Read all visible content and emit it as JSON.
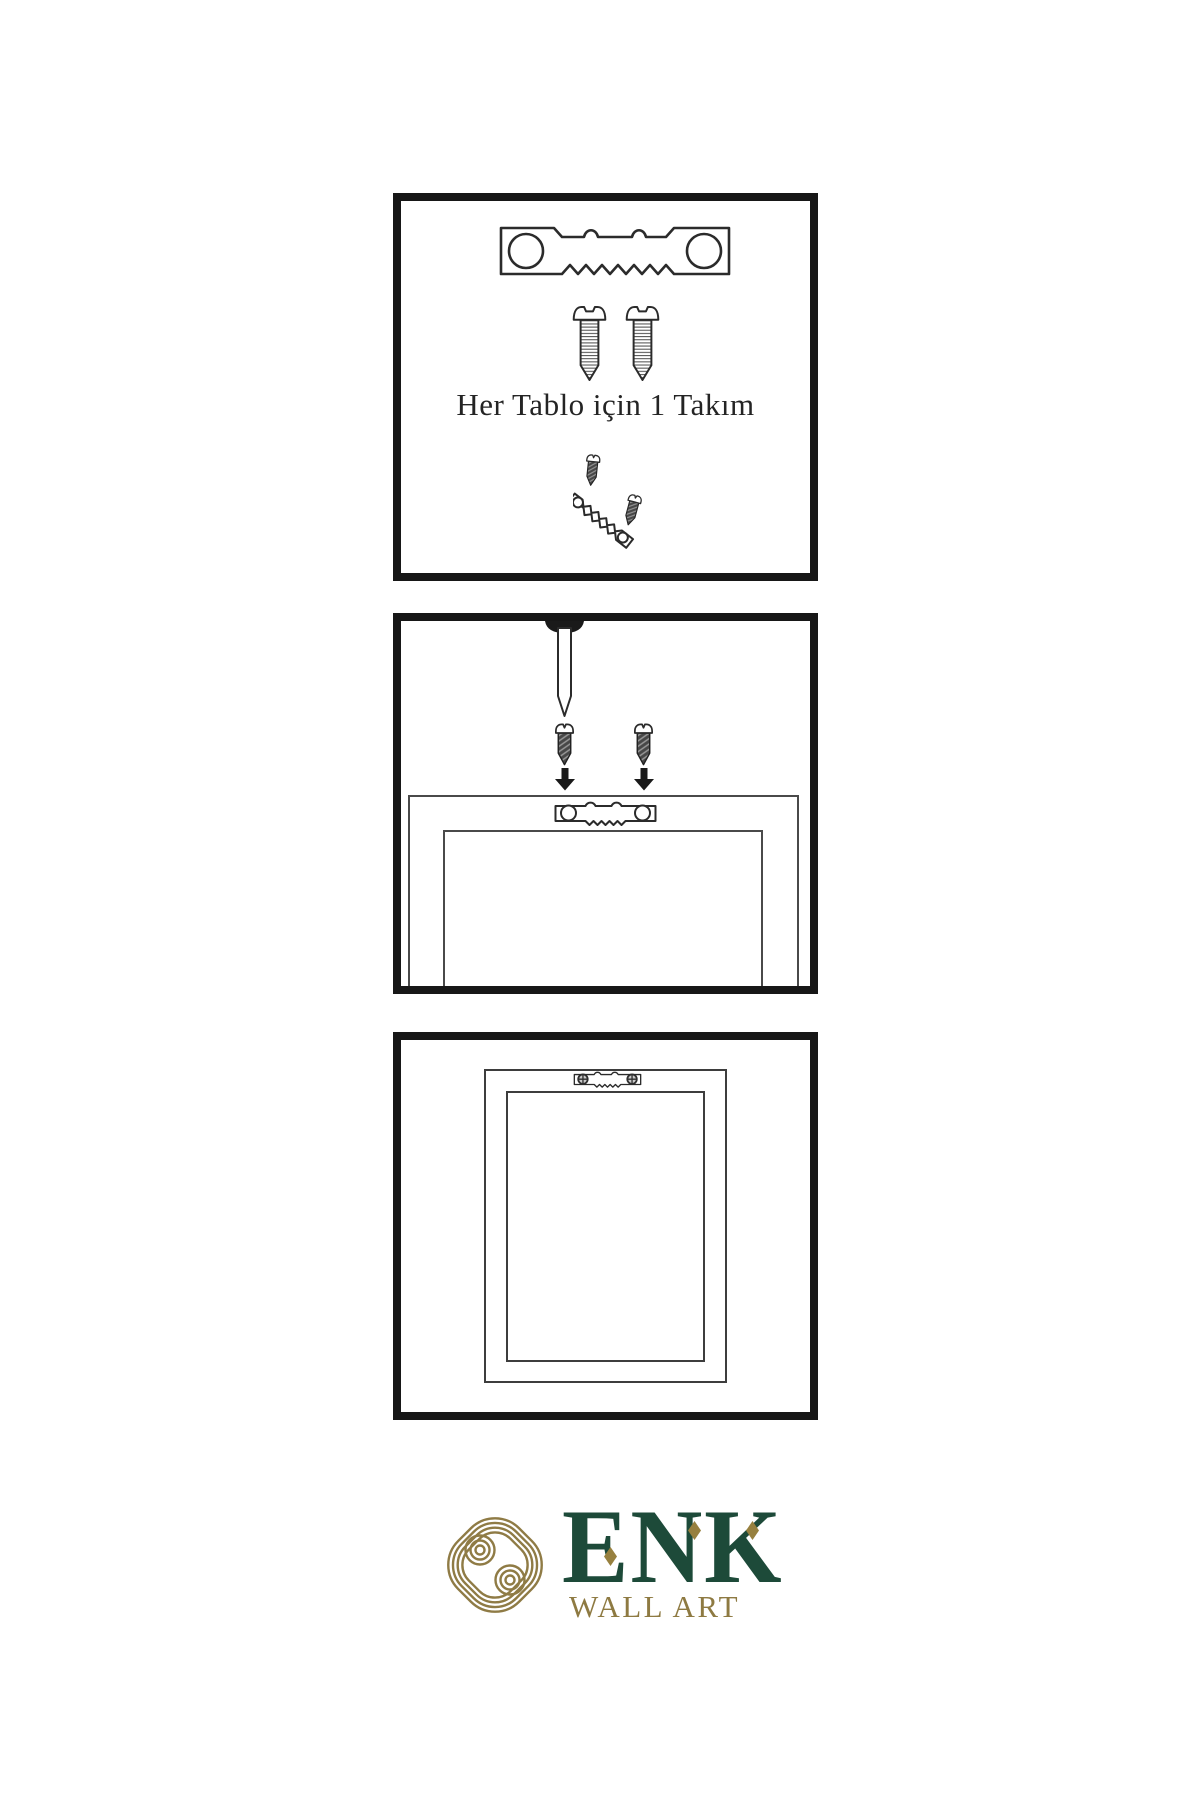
{
  "page": {
    "background": "#ffffff"
  },
  "steps": {
    "step1": {
      "caption": "Her Tablo için 1 Takım",
      "icons": [
        "sawtooth-hanger-icon",
        "screw-icon",
        "screw-icon",
        "tilted-hanger-with-screws-icon"
      ]
    },
    "step2": {
      "icons": [
        "wall-nail-icon",
        "screw-icon",
        "screw-icon",
        "arrow-down-icon",
        "arrow-down-icon",
        "sawtooth-hanger-icon",
        "frame-back-outline"
      ]
    },
    "step3": {
      "icons": [
        "hanging-frame-outline",
        "sawtooth-hanger-with-screws-icon"
      ]
    }
  },
  "brand": {
    "name": "ENK",
    "tagline": "WALL ART",
    "logo_icon": "interlocking-knot-icon",
    "colors": {
      "green": "#1d4a39",
      "gold": "#8e7a42",
      "ink": "#171717"
    }
  }
}
